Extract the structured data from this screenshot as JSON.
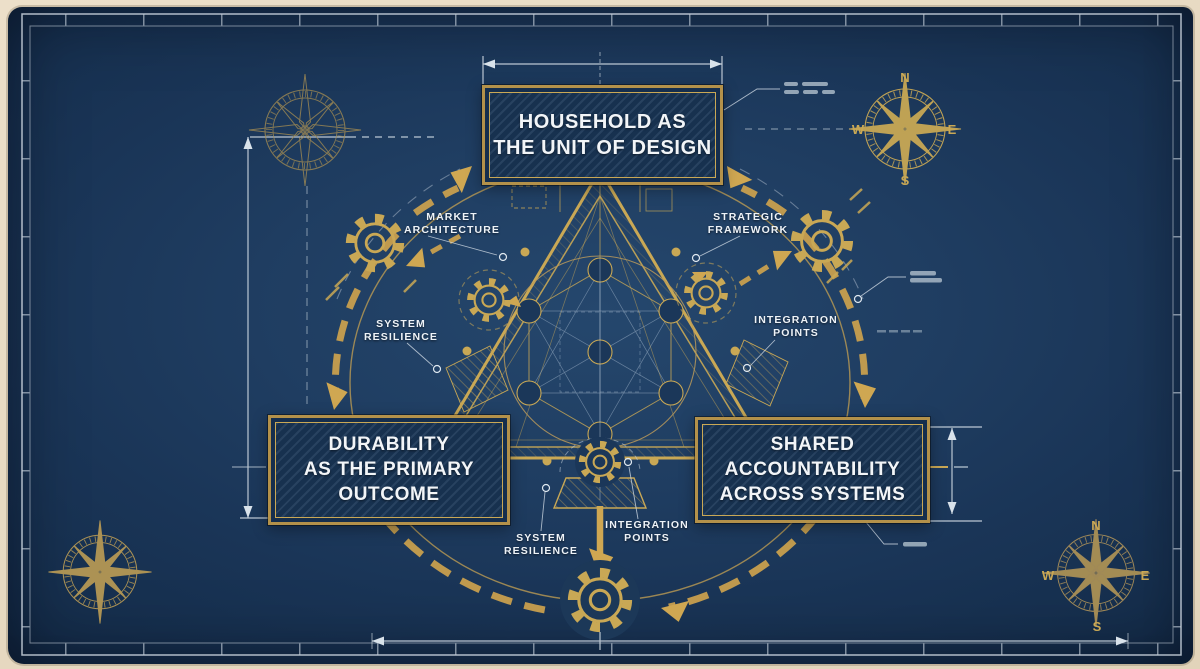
{
  "board": {
    "nodes": {
      "top": {
        "lines": [
          "HOUSEHOLD AS",
          "THE UNIT OF DESIGN"
        ]
      },
      "left": {
        "lines": [
          "DURABILITY",
          "AS THE PRIMARY",
          "OUTCOME"
        ]
      },
      "right": {
        "lines": [
          "SHARED",
          "ACCOUNTABILITY",
          "ACROSS SYSTEMS"
        ]
      }
    },
    "callouts": [
      {
        "id": "market-architecture",
        "lines": [
          "MARKET",
          "ARCHITECTURE"
        ]
      },
      {
        "id": "strategic-framework",
        "lines": [
          "STRATEGIC",
          "FRAMEWORK"
        ]
      },
      {
        "id": "system-resilience-left",
        "lines": [
          "SYSTEM",
          "RESILIENCE"
        ]
      },
      {
        "id": "integration-points-right",
        "lines": [
          "INTEGRATION",
          "POINTS"
        ]
      },
      {
        "id": "system-resilience-bottom",
        "lines": [
          "SYSTEM",
          "RESILIENCE"
        ]
      },
      {
        "id": "integration-points-bottom",
        "lines": [
          "INTEGRATION",
          "POINTS"
        ]
      }
    ],
    "compass_top_right": {
      "n": "N",
      "e": "E",
      "s": "S",
      "w": "W"
    },
    "compass_bottom_right": {
      "n": "N",
      "e": "E",
      "s": "S",
      "w": "W"
    },
    "colors": {
      "paper": "#e9ddc7",
      "navy": "#1e3c60",
      "navy_dark": "#142c49",
      "gold": "#c9a855",
      "gold_bright": "#cfa752",
      "line_white": "#d9e2ea",
      "text_white": "#f2f5f8"
    }
  }
}
